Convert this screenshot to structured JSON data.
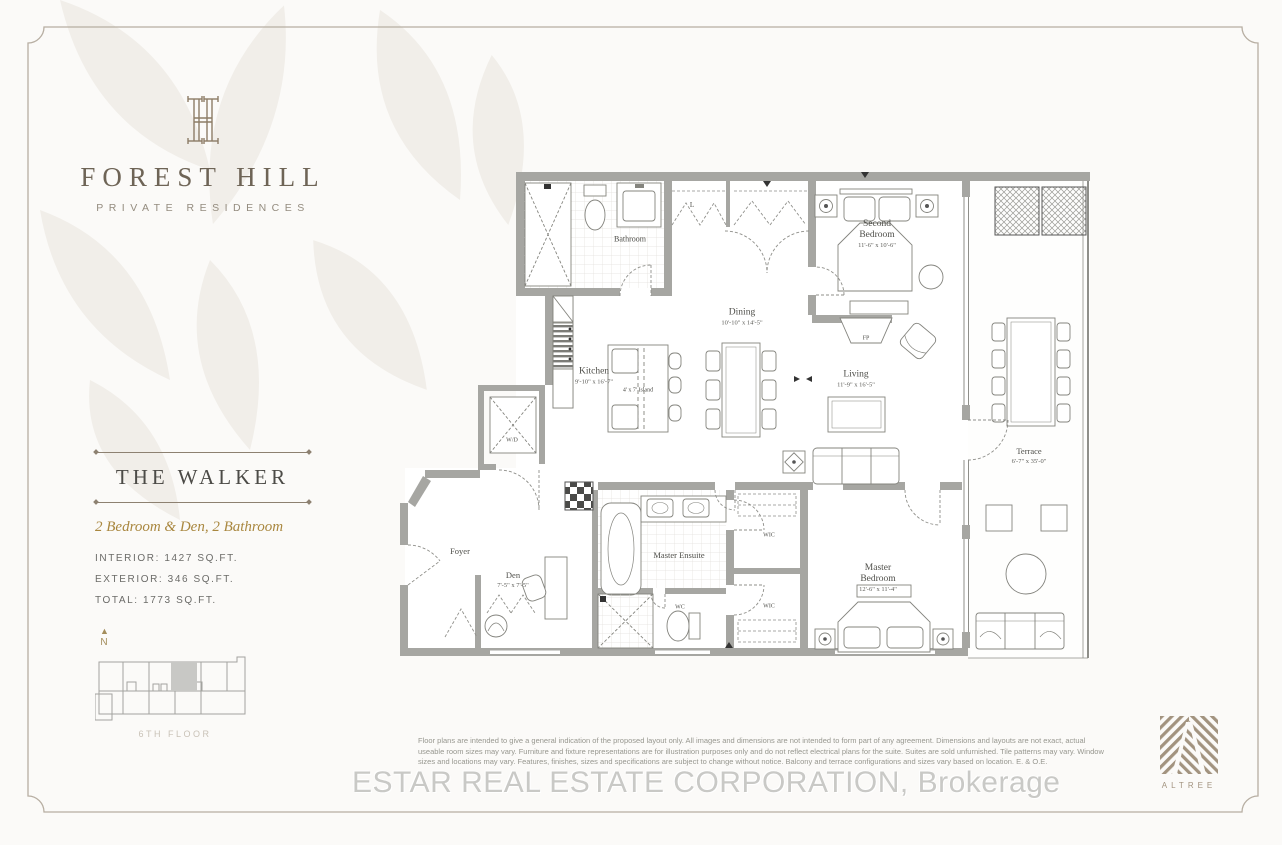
{
  "branding": {
    "name": "FOREST HILL",
    "tagline": "PRIVATE RESIDENCES",
    "monogram_icon": "fh-monogram-icon"
  },
  "unit": {
    "name": "THE WALKER",
    "type": "2 Bedroom & Den, 2 Bathroom",
    "interior": "INTERIOR: 1427 SQ.FT.",
    "exterior": "EXTERIOR: 346 SQ.FT.",
    "total": "TOTAL: 1773 SQ.FT."
  },
  "keyplan": {
    "north_label": "N",
    "floor_label": "6TH FLOOR"
  },
  "floorplan": {
    "rooms": [
      {
        "label": "Bathroom"
      },
      {
        "label": "L"
      },
      {
        "label": "Second Bedroom",
        "dims": "11'-6\" x 10'-6\""
      },
      {
        "label": "Dining",
        "dims": "10'-10\" x 14'-5\""
      },
      {
        "label": "Kitchen",
        "dims": "9'-10\" x 16'-7\""
      },
      {
        "label": "4' x 7' Island"
      },
      {
        "label": "Living",
        "dims": "11'-9\" x 16'-5\""
      },
      {
        "label": "FP"
      },
      {
        "label": "W/D"
      },
      {
        "label": "Foyer"
      },
      {
        "label": "Den",
        "dims": "7'-5\" x 7'-5\""
      },
      {
        "label": "Master Ensuite"
      },
      {
        "label": "WC"
      },
      {
        "label": "WIC"
      },
      {
        "label": "WIC"
      },
      {
        "label": "Master Bedroom",
        "dims": "12'-6\" x 11'-4\""
      },
      {
        "label": "Terrace",
        "dims": "6'-7\" x 35'-0\""
      }
    ]
  },
  "disclaimer": "Floor plans are intended to give a general indication of the proposed layout only. All images and dimensions are not intended to form part of any agreement. Dimensions and layouts are not exact, actual useable room sizes may vary. Furniture and fixture representations are for illustration purposes only and do not reflect electrical plans for the suite. Suites are sold unfurnished. Tile patterns may vary. Window sizes and locations may vary. Features, finishes, sizes and specifications are subject to change without notice. Balcony and terrace configurations and sizes vary based on location. E. & O.E.",
  "watermark": "ESTAR REAL ESTATE CORPORATION, Brokerage",
  "developer": {
    "name": "ALTREE"
  },
  "colors": {
    "brand_taupe": "#8d7c66",
    "gold_accent": "#a9873f",
    "wall_gray": "#a6a6a2",
    "page_background": "#fbfaf8"
  }
}
